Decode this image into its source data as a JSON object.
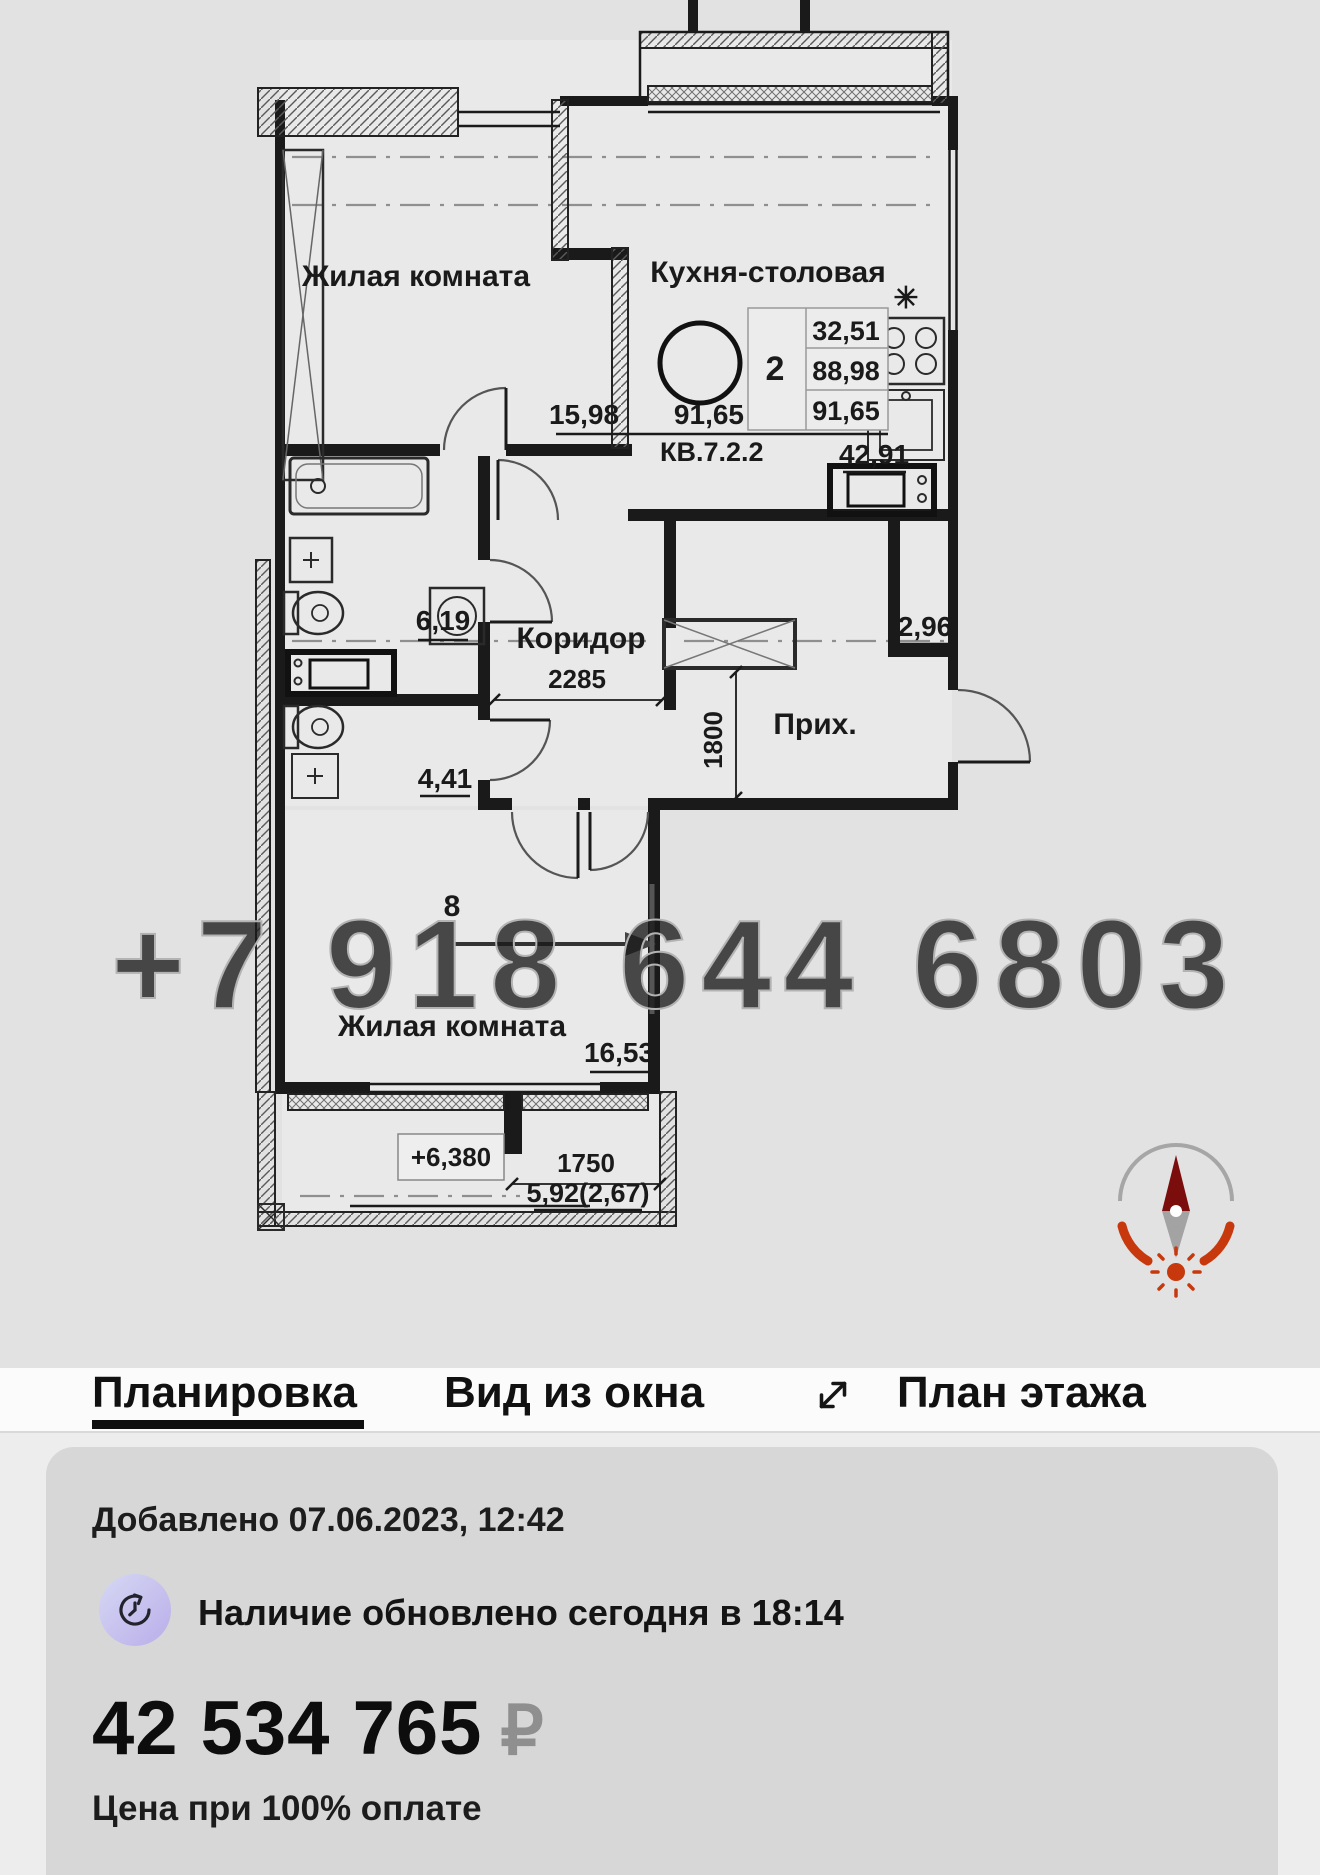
{
  "plan": {
    "watermark": "+7 918 644 6803",
    "living1": {
      "name": "Жилая комната",
      "area": "15,98"
    },
    "kitchen": {
      "name": "Кухня-столовая",
      "area": "42,91",
      "stove_mark": "✳"
    },
    "stamp": {
      "rooms": "2",
      "col": [
        "32,51",
        "88,98",
        "91,65"
      ],
      "total": "91,65",
      "unit": "КВ.7.2.2"
    },
    "bath": {
      "area": "6,19"
    },
    "wc": {
      "area": "4,41"
    },
    "corridor": {
      "name": "Коридор",
      "dim": "2285"
    },
    "hall": {
      "name": "Прих.",
      "area": "2,96",
      "dim": "1800"
    },
    "living2": {
      "name": "Жилая комната",
      "area": "16,53",
      "mark": "8"
    },
    "balcony": {
      "level": "+6,380",
      "dim": "1750",
      "area": "5,92(2,67)"
    }
  },
  "tabs": {
    "layout": "Планировка",
    "view": "Вид из окна",
    "floor": "План этажа"
  },
  "card": {
    "added": "Добавлено 07.06.2023, 12:42",
    "availability": "Наличие обновлено сегодня в 18:14",
    "price": "42 534 765",
    "currency": "₽",
    "price_note": "Цена при 100% оплате"
  },
  "colors": {
    "accent": "#c8380d",
    "north": "#7c0d0d",
    "badge": "#c9c8ef"
  }
}
